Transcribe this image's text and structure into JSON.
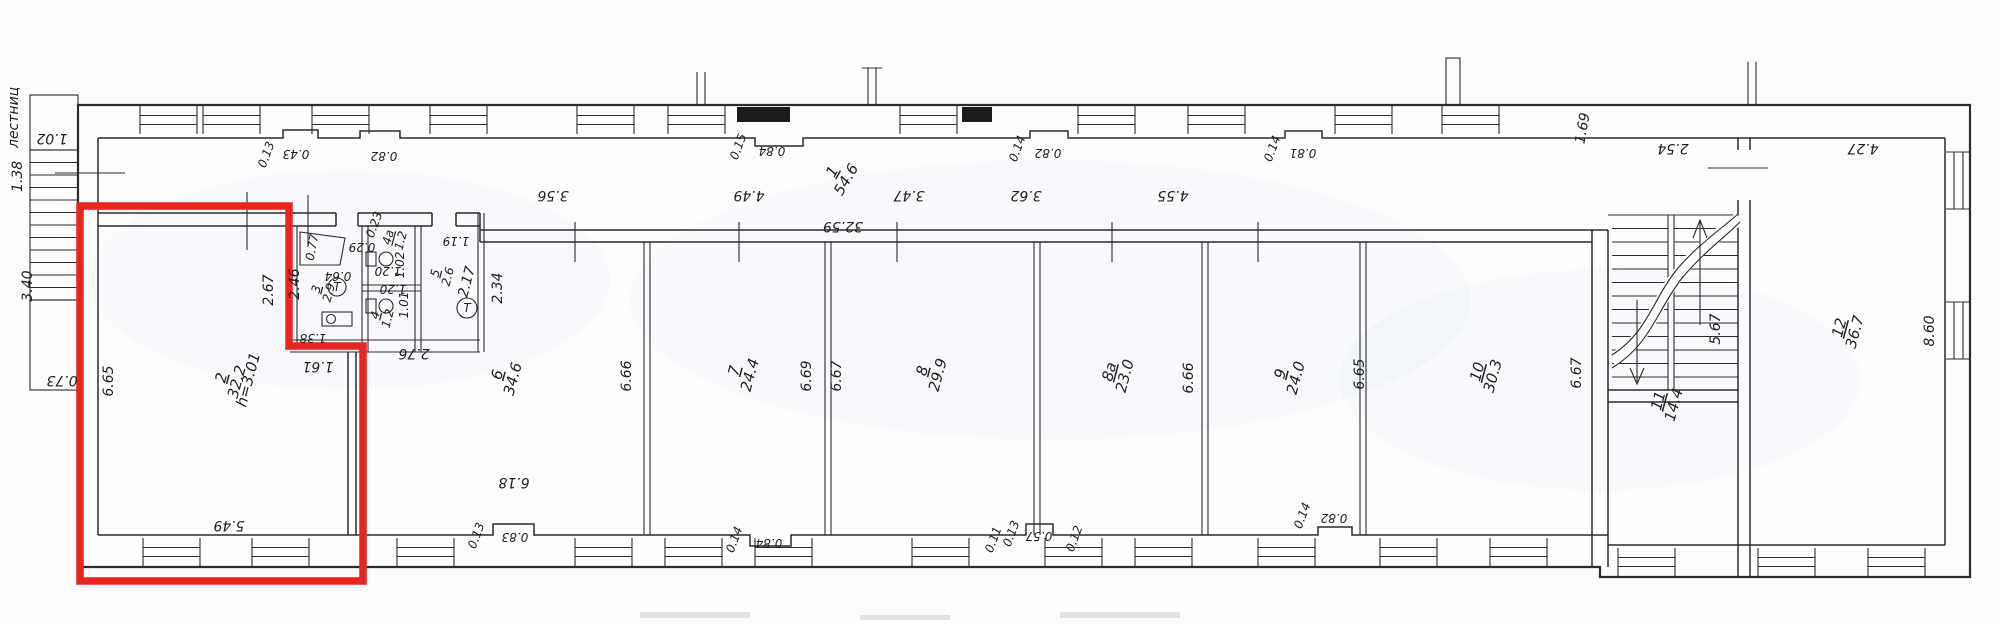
{
  "drawing_type": "floor-plan-scan",
  "colors": {
    "highlight": "#e8251f",
    "line": "#2b2b2b",
    "paper": "#fdfdfe"
  },
  "stairs_text": "лестниц",
  "fixture_t": "T",
  "rooms": [
    {
      "num": "1",
      "area": "54.6"
    },
    {
      "num": "2",
      "area": "32.2",
      "note": "h=3.01"
    },
    {
      "num": "3",
      "area": "2.9"
    },
    {
      "num": "4",
      "area": "1.2"
    },
    {
      "num": "4a",
      "area": "1.2"
    },
    {
      "num": "5",
      "area": "2.6"
    },
    {
      "num": "6",
      "area": "34.6"
    },
    {
      "num": "7",
      "area": "24.4"
    },
    {
      "num": "8",
      "area": "29.9"
    },
    {
      "num": "8a",
      "area": "23.0"
    },
    {
      "num": "9",
      "area": "24.0"
    },
    {
      "num": "10",
      "area": "30.3"
    },
    {
      "num": "11",
      "area": "14.4"
    },
    {
      "num": "12",
      "area": "36.7"
    }
  ],
  "dims": [
    "1.38",
    "1.02",
    "3.40",
    "0.73",
    "6.65",
    "5.49",
    "2.67",
    "2.46",
    "1.61",
    "1.38",
    "0.77",
    "0.64",
    "0.23",
    "0.29",
    "1.20",
    "1.02",
    "1.20",
    "1.01",
    "1.19",
    "2.17",
    "2.34",
    "2.76",
    "6.18",
    "6.66",
    "6.69",
    "6.67",
    "6.66",
    "6.65",
    "6.67",
    "3.56",
    "4.49",
    "3.47",
    "3.62",
    "4.55",
    "0.13",
    "0.43",
    "0.82",
    "0.15",
    "0.84",
    "32.59",
    "0.14",
    "0.82",
    "0.14",
    "0.81",
    "1.69",
    "2.54",
    "4.27",
    "0.13",
    "0.83",
    "0.14",
    "0.84",
    "0.11",
    "0.13",
    "0.57",
    "0.12",
    "0.14",
    "0.82",
    "5.67",
    "8.60"
  ]
}
